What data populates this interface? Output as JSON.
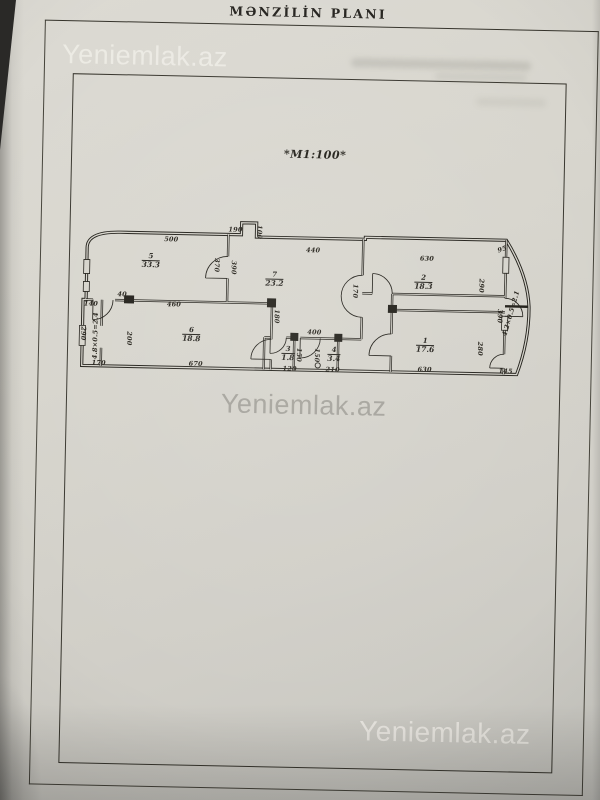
{
  "document": {
    "title": "MƏNZİLİN PLANI",
    "scale_label": "*M1:100*"
  },
  "watermarks": [
    {
      "position": "top-left",
      "text": "Yeniemlak.az"
    },
    {
      "position": "center",
      "text": "Yeniemlak.az"
    },
    {
      "position": "bottom-right",
      "text": "Yeniemlak.az"
    }
  ],
  "colors": {
    "paper": "#d6d4cc",
    "ink": "#26241e",
    "watermark_gray": "#8a8881"
  },
  "plan": {
    "scale": "M1:100",
    "rooms": [
      {
        "number": "5",
        "area": "33.3",
        "x": 73,
        "y": 52
      },
      {
        "number": "7",
        "area": "23.2",
        "x": 197,
        "y": 68
      },
      {
        "number": "2",
        "area": "18.3",
        "x": 346,
        "y": 68
      },
      {
        "number": "6",
        "area": "18.8",
        "x": 115,
        "y": 125
      },
      {
        "number": "3",
        "area": "1.8",
        "x": 212,
        "y": 142
      },
      {
        "number": "4",
        "area": "3.4",
        "x": 258,
        "y": 142
      },
      {
        "number": "1",
        "area": "17.6",
        "x": 349,
        "y": 131
      }
    ],
    "dimensions": [
      {
        "text": "500",
        "x": 93,
        "y": 30,
        "rot": 0
      },
      {
        "text": "190",
        "x": 157,
        "y": 19,
        "rot": 0
      },
      {
        "text": "100",
        "x": 181,
        "y": 21,
        "rot": 90
      },
      {
        "text": "440",
        "x": 235,
        "y": 38,
        "rot": 0
      },
      {
        "text": "630",
        "x": 349,
        "y": 44,
        "rot": 0
      },
      {
        "text": "95",
        "x": 424,
        "y": 33,
        "rot": -20
      },
      {
        "text": "370",
        "x": 139,
        "y": 55,
        "rot": 90
      },
      {
        "text": "390",
        "x": 156,
        "y": 57,
        "rot": 90
      },
      {
        "text": "140",
        "x": 14,
        "y": 96,
        "rot": 0
      },
      {
        "text": "40",
        "x": 45,
        "y": 86,
        "rot": 0
      },
      {
        "text": "460",
        "x": 97,
        "y": 95,
        "rot": 0
      },
      {
        "text": "290",
        "x": 7,
        "y": 126,
        "rot": 90
      },
      {
        "text": "4.8×0.5=2.4",
        "x": 19,
        "y": 128,
        "rot": -90
      },
      {
        "text": "170",
        "x": 23,
        "y": 155,
        "rot": 0
      },
      {
        "text": "200",
        "x": 53,
        "y": 130,
        "rot": 90
      },
      {
        "text": "670",
        "x": 120,
        "y": 154,
        "rot": 0
      },
      {
        "text": "180",
        "x": 200,
        "y": 105,
        "rot": 90
      },
      {
        "text": "120",
        "x": 214,
        "y": 157,
        "rot": 0
      },
      {
        "text": "150",
        "x": 223,
        "y": 143,
        "rot": 90
      },
      {
        "text": "150",
        "x": 241,
        "y": 143,
        "rot": 90
      },
      {
        "text": "400",
        "x": 238,
        "y": 120,
        "rot": 0
      },
      {
        "text": "210",
        "x": 257,
        "y": 157,
        "rot": 0
      },
      {
        "text": "170",
        "x": 278,
        "y": 78,
        "rot": 90
      },
      {
        "text": "290",
        "x": 404,
        "y": 70,
        "rot": 90
      },
      {
        "text": "390",
        "x": 423,
        "y": 100,
        "rot": 90
      },
      {
        "text": "4.2×0.5=2.1",
        "x": 434,
        "y": 97,
        "rot": -75
      },
      {
        "text": "280",
        "x": 404,
        "y": 133,
        "rot": 90
      },
      {
        "text": "630",
        "x": 349,
        "y": 155,
        "rot": 0
      },
      {
        "text": "145",
        "x": 430,
        "y": 155,
        "rot": 0
      }
    ]
  }
}
